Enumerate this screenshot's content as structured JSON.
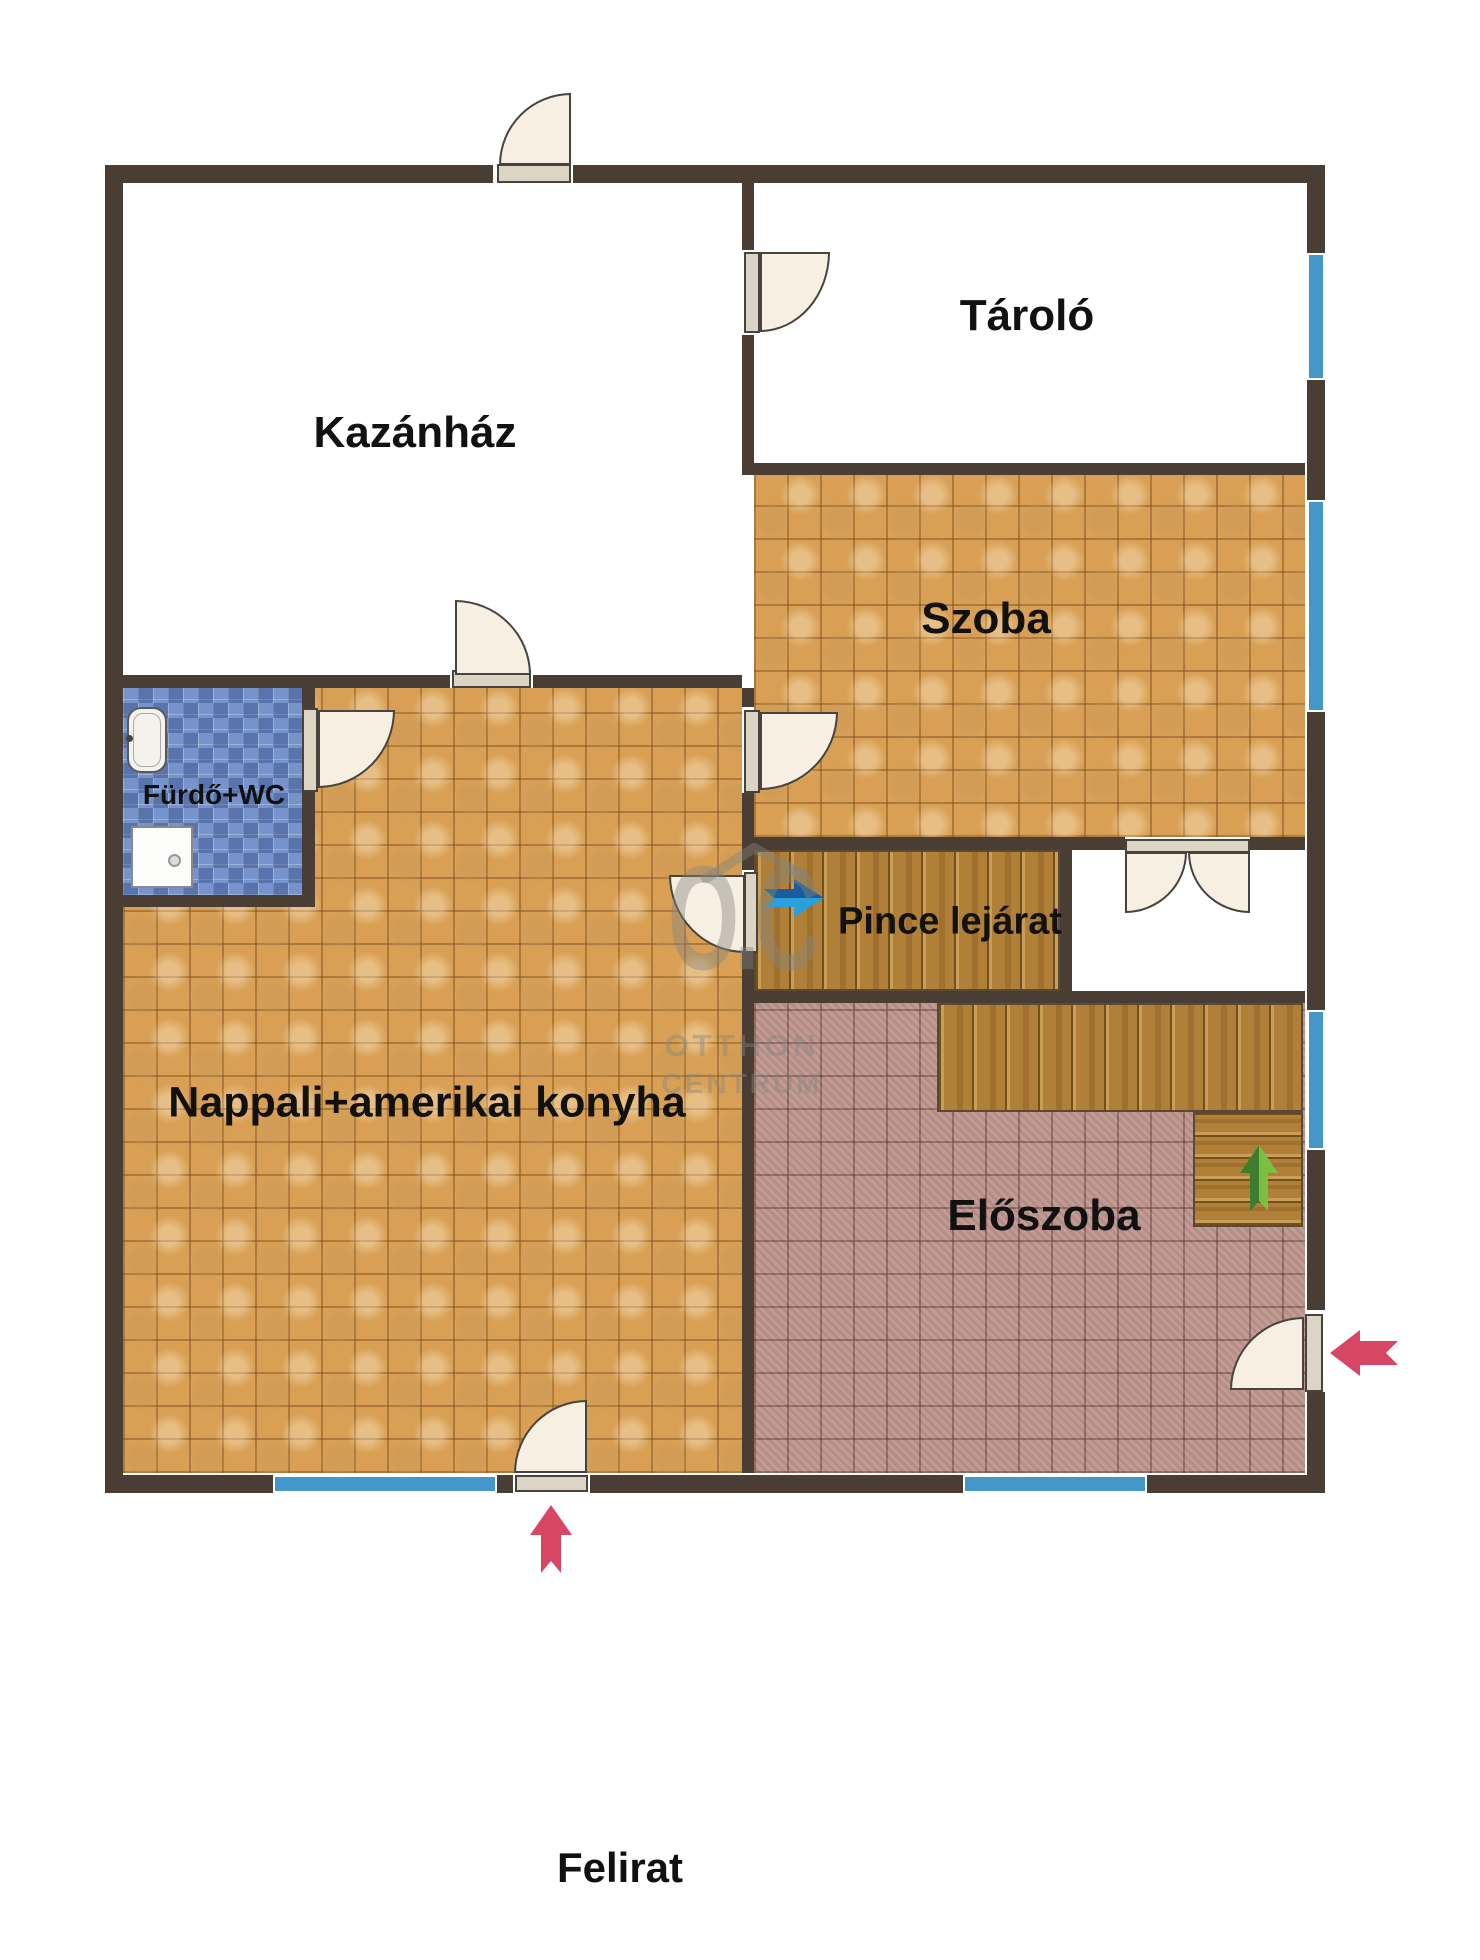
{
  "rooms": {
    "kazanhaz": {
      "label": "Kazánház"
    },
    "tarolo": {
      "label": "Tároló"
    },
    "szoba": {
      "label": "Szoba"
    },
    "furdo_wc": {
      "label": "Fürdő+WC"
    },
    "pince_lejarat": {
      "label": "Pince lejárat"
    },
    "nappali": {
      "label": "Nappali+amerikai konyha"
    },
    "eloszoba": {
      "label": "Előszoba"
    }
  },
  "caption": {
    "text": "Felirat"
  },
  "watermark": {
    "logo": "O.C",
    "line1": "OTTHON",
    "line2": "CENTRUM"
  },
  "colors": {
    "wall": "#4a3d33",
    "window": "#4498c8",
    "tile-orange": "#d9a055",
    "tile-pink": "#bc948d",
    "tile-blue": "#7693cb",
    "wood": "#b08038",
    "door-leaf": "#f7efe2",
    "arrow-red": "#d84666",
    "arrow-green": "#7cc043",
    "arrow-green-dark": "#3e7d2e",
    "arrow-blue": "#2aa0dc",
    "arrow-blue-dark": "#1b5d9c",
    "label": "#111111",
    "watermark": "#85857f"
  }
}
